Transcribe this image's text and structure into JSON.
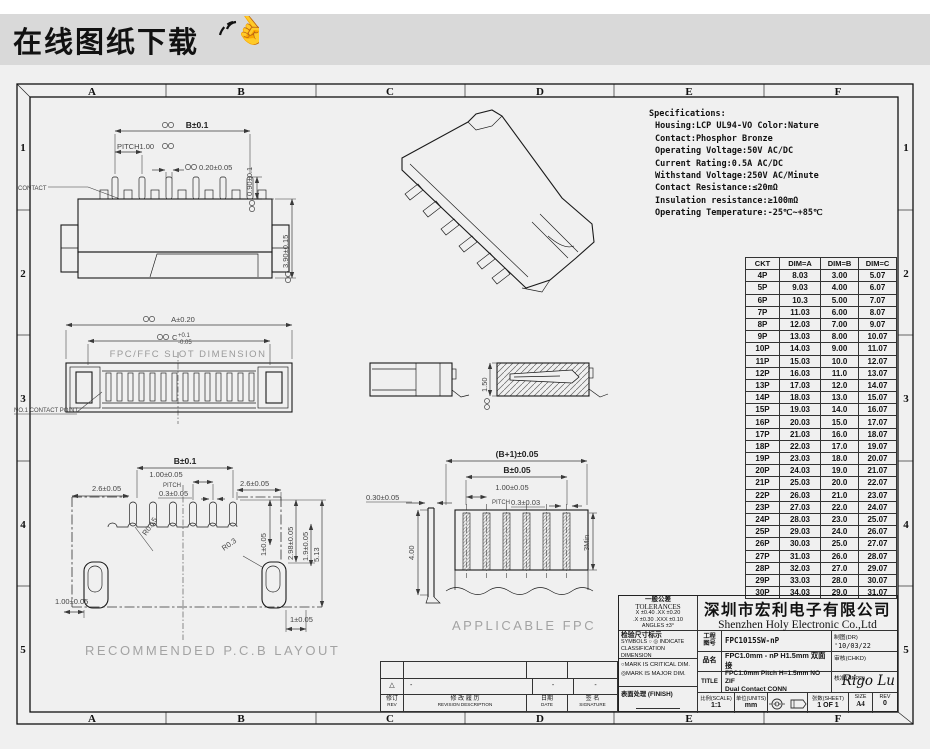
{
  "banner": {
    "title": "在线图纸下载"
  },
  "frame": {
    "columns": [
      "A",
      "B",
      "C",
      "D",
      "E",
      "F"
    ],
    "rows": [
      "1",
      "2",
      "3",
      "4",
      "5"
    ]
  },
  "specifications": {
    "title": "Specifications:",
    "lines": [
      "Housing:LCP UL94-VO Color:Nature",
      "Contact:Phosphor Bronze",
      "Operating Voltage:50V AC/DC",
      "Current Rating:0.5A AC/DC",
      "Withstand Voltage:250V AC/Minute",
      "Contact Resistance:≤20mΩ",
      "Insulation resistance:≥100mΩ",
      "Operating Temperature:-25℃~+85℃"
    ]
  },
  "ckt_table": {
    "headers": [
      "CKT",
      "DIM=A",
      "DIM=B",
      "DIM=C"
    ],
    "rows": [
      [
        "4P",
        "8.03",
        "3.00",
        "5.07"
      ],
      [
        "5P",
        "9.03",
        "4.00",
        "6.07"
      ],
      [
        "6P",
        "10.3",
        "5.00",
        "7.07"
      ],
      [
        "7P",
        "11.03",
        "6.00",
        "8.07"
      ],
      [
        "8P",
        "12.03",
        "7.00",
        "9.07"
      ],
      [
        "9P",
        "13.03",
        "8.00",
        "10.07"
      ],
      [
        "10P",
        "14.03",
        "9.00",
        "11.07"
      ],
      [
        "11P",
        "15.03",
        "10.0",
        "12.07"
      ],
      [
        "12P",
        "16.03",
        "11.0",
        "13.07"
      ],
      [
        "13P",
        "17.03",
        "12.0",
        "14.07"
      ],
      [
        "14P",
        "18.03",
        "13.0",
        "15.07"
      ],
      [
        "15P",
        "19.03",
        "14.0",
        "16.07"
      ],
      [
        "16P",
        "20.03",
        "15.0",
        "17.07"
      ],
      [
        "17P",
        "21.03",
        "16.0",
        "18.07"
      ],
      [
        "18P",
        "22.03",
        "17.0",
        "19.07"
      ],
      [
        "19P",
        "23.03",
        "18.0",
        "20.07"
      ],
      [
        "20P",
        "24.03",
        "19.0",
        "21.07"
      ],
      [
        "21P",
        "25.03",
        "20.0",
        "22.07"
      ],
      [
        "22P",
        "26.03",
        "21.0",
        "23.07"
      ],
      [
        "23P",
        "27.03",
        "22.0",
        "24.07"
      ],
      [
        "24P",
        "28.03",
        "23.0",
        "25.07"
      ],
      [
        "25P",
        "29.03",
        "24.0",
        "26.07"
      ],
      [
        "26P",
        "30.03",
        "25.0",
        "27.07"
      ],
      [
        "27P",
        "31.03",
        "26.0",
        "28.07"
      ],
      [
        "28P",
        "32.03",
        "27.0",
        "29.07"
      ],
      [
        "29P",
        "33.03",
        "28.0",
        "30.07"
      ],
      [
        "30P",
        "34.03",
        "29.0",
        "31.07"
      ]
    ]
  },
  "views": {
    "front_view": {
      "contact_label": "CONTACT",
      "dim_b": "B±0.1",
      "dim_pitch": "PITCH1.00",
      "dim_slot_w": "0.20±0.05",
      "dim_pin_h": "0.90±0.1",
      "dim_body_h": "3.90±0.15"
    },
    "slot_view": {
      "dim_a": "A±0.20",
      "dim_c": "C",
      "dim_c_upper": "+0.1",
      "dim_c_lower": "-0.05",
      "slot_label": "FPC/FFC SLOT DIMENSION",
      "contact_point_label": "NO.1 CONTACT POINT"
    },
    "section_view": {
      "dim_height": "1.50"
    },
    "pcb_layout": {
      "caption": "RECOMMENDED P.C.B LAYOUT",
      "dim_b": "B±0.1",
      "dim_pad_pitch": "1.00±0.05",
      "pitch_label": "PITCH",
      "dim_pad_w": "0.3±0.05",
      "dim_left": "2.6±0.05",
      "dim_right": "2.6±0.05",
      "r1": "R0.15",
      "r2": "R0.3",
      "dim_v1": "1±0.05",
      "dim_v2": "2.98±0.05",
      "dim_v3": "1.9±0.05",
      "dim_v4": "5.13",
      "dim_bl": "1.00±0.05",
      "dim_br": "1±0.05"
    },
    "fpc_view": {
      "caption": "APPLICABLE FPC",
      "dim_total": "(B+1)±0.05",
      "dim_b": "B±0.05",
      "dim_pitch": "1.00±0.05",
      "pitch_label": "PITCH",
      "dim_w": "0.3±0.03",
      "dim_t": "0.30±0.05",
      "dim_len": "4.00",
      "dim_min": "3Min"
    }
  },
  "title_block": {
    "tolerances": {
      "title_cn": "一般公差",
      "title_en": "TOLERANCES",
      "line1": "X ±0.40   .XX ±0.20",
      "line2": ".X ±0.30  .XXX ±0.10",
      "line3": "ANGLES      ±3°"
    },
    "company_cn": "深圳市宏利电子有限公司",
    "company_en": "Shenzhen Holy Electronic Co.,Ltd",
    "symbols": {
      "title": "检验尺寸标示",
      "line1": "SYMBOLS ○ ◎ INDICATE",
      "line2": "CLASSIFICATION DIMENSION",
      "mark1": "○MARK IS CRITICAL DIM.",
      "mark2": "◎MARK IS MAJOR DIM."
    },
    "finish_label": "表面处理 (FINISH)",
    "drawing_no_label1": "工程",
    "drawing_no_label2": "图号",
    "drawing_no": "FPC1015SW-nP",
    "part_name_label": "品名",
    "part_name": "FPC1.0mm - nP H1.5mm 双面接",
    "title_label": "TITLE",
    "title_line1": "FPC1.0mm Pitch H=1.5mm NO ZIF",
    "title_line2": "Dual Contact CONN",
    "drawn_label": "制图(DR)",
    "drawn_value": "'10/03/22",
    "checked_label": "审核(CHKD)",
    "approved_label": "核准(APPD)",
    "approved_value": "Rigo Lu",
    "scale_label": "比例(SCALE)",
    "scale_value": "1:1",
    "units_label": "单位(UNITS)",
    "units_value": "mm",
    "sheet_label": "张数(SHEET)",
    "sheet_value": "1 OF 1",
    "size_label": "SIZE",
    "size_value": "A4",
    "rev_label": "REV",
    "rev_value": "0"
  },
  "revision_table": {
    "rev_label": "修订",
    "rev_label_en": "REV",
    "desc_label": "修 改 履 历",
    "desc_label_en": "REVISION DESCRIPTION",
    "date_label": "日期",
    "date_label_en": "DATE",
    "sign_label": "签 名",
    "sign_label_en": "SIGNATURE",
    "marks": {
      "rev": "△",
      "desc": "-",
      "date": "-",
      "sign": "-"
    }
  }
}
